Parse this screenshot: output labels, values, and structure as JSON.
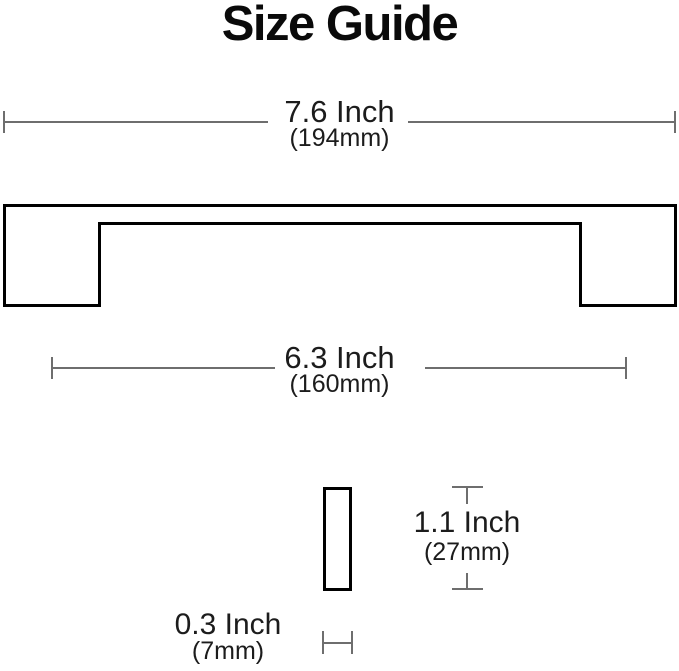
{
  "title": "Size Guide",
  "colors": {
    "background": "#ffffff",
    "title_text": "#0a0a0a",
    "label_text": "#1c1c1c",
    "dimension_line": "#6e6e6e",
    "outline": "#000000"
  },
  "front_view": {
    "description": "handle front outline",
    "overall_length": {
      "inches": "7.6 Inch",
      "metric": "(194mm)"
    },
    "hole_spacing": {
      "inches": "6.3 Inch",
      "metric": "(160mm)"
    }
  },
  "side_view": {
    "description": "handle side cross-section",
    "height": {
      "inches": "1.1 Inch",
      "metric": "(27mm)"
    },
    "thickness": {
      "inches": "0.3 Inch",
      "metric": "(7mm)"
    }
  }
}
